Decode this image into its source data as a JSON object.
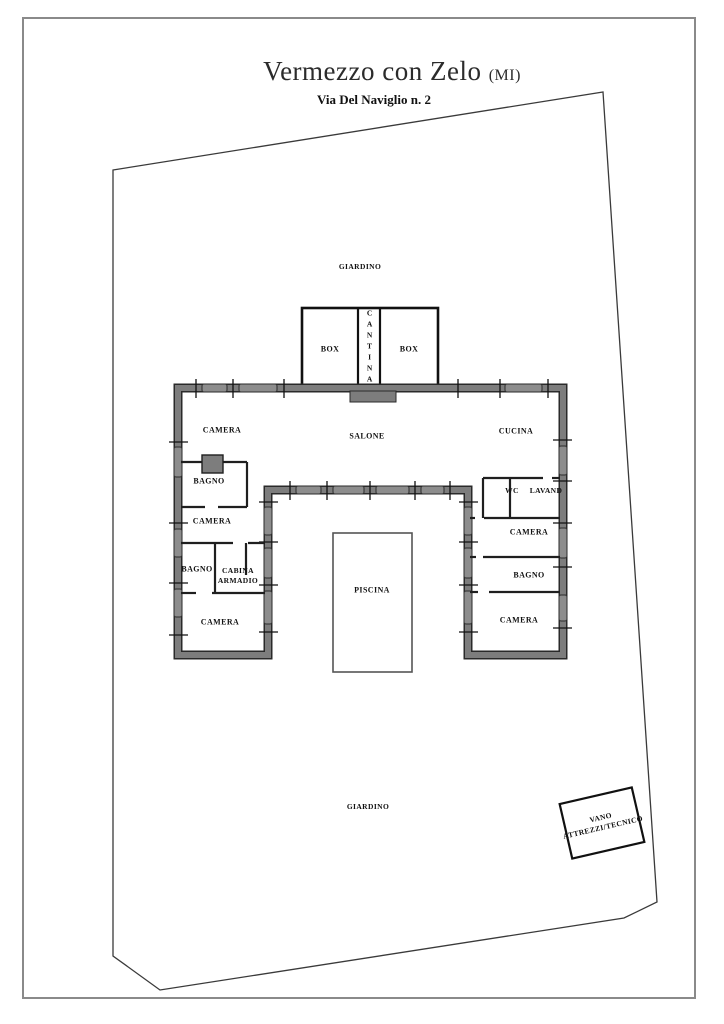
{
  "header": {
    "title": "Vermezzo con Zelo",
    "title_suffix": "(MI)",
    "subtitle": "Via Del Naviglio n. 2"
  },
  "colors": {
    "frame_gray": "#8a8a8a",
    "boundary_line": "#3a3a3a",
    "wall_gray": "#7d7d7d",
    "wall_casing": "#2a2a2a",
    "partition_black": "#1f1f1f",
    "paper_white": "#ffffff"
  },
  "plan": {
    "labels": [
      {
        "id": "giardino-top",
        "text": "GIARDINO",
        "x": 360,
        "y": 267,
        "class": "small"
      },
      {
        "id": "giardino-bottom",
        "text": "GIARDINO",
        "x": 368,
        "y": 807,
        "class": "small"
      },
      {
        "id": "box-left",
        "text": "BOX",
        "x": 330,
        "y": 350
      },
      {
        "id": "cantina",
        "text": "CANTINA",
        "x": 369,
        "y": 347,
        "vertical": true,
        "class": "small"
      },
      {
        "id": "box-right",
        "text": "BOX",
        "x": 409,
        "y": 350
      },
      {
        "id": "salone",
        "text": "SALONE",
        "x": 367,
        "y": 437
      },
      {
        "id": "camera-nw",
        "text": "CAMERA",
        "x": 222,
        "y": 431
      },
      {
        "id": "bagno-w1",
        "text": "BAGNO",
        "x": 209,
        "y": 482
      },
      {
        "id": "camera-w2",
        "text": "CAMERA",
        "x": 212,
        "y": 522
      },
      {
        "id": "bagno-w2",
        "text": "BAGNO",
        "x": 197,
        "y": 570
      },
      {
        "id": "cabina-armadio",
        "text": "CABINA\nARMADIO",
        "x": 238,
        "y": 576,
        "class": "small"
      },
      {
        "id": "camera-sw",
        "text": "CAMERA",
        "x": 220,
        "y": 623
      },
      {
        "id": "cucina",
        "text": "CUCINA",
        "x": 516,
        "y": 432
      },
      {
        "id": "wc",
        "text": "WC",
        "x": 512,
        "y": 491,
        "class": "small"
      },
      {
        "id": "lavand",
        "text": "LAVAND",
        "x": 546,
        "y": 491,
        "class": "small"
      },
      {
        "id": "camera-e1",
        "text": "CAMERA",
        "x": 529,
        "y": 533
      },
      {
        "id": "bagno-e",
        "text": "BAGNO",
        "x": 529,
        "y": 576
      },
      {
        "id": "camera-se",
        "text": "CAMERA",
        "x": 519,
        "y": 621
      },
      {
        "id": "piscina",
        "text": "PISCINA",
        "x": 372,
        "y": 591
      },
      {
        "id": "vano-attrezzi",
        "text": "VANO\nATTREZZI/TECNICO",
        "x": 602,
        "y": 823,
        "rotate": -13,
        "width": 84,
        "class": "small"
      }
    ]
  }
}
